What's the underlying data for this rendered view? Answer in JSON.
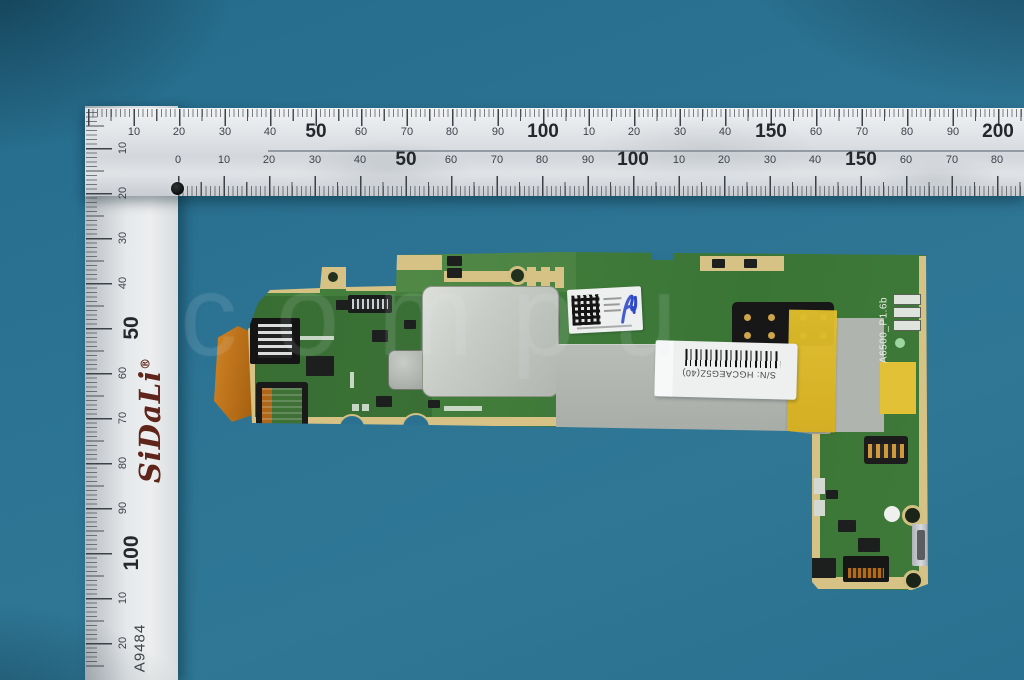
{
  "scene": {
    "description": "Tablet motherboard PCB photographed on a teal background with an L-square metal ruler",
    "background_color": "#2d7494",
    "watermark": "compu"
  },
  "ruler": {
    "brand": "SiDaLi",
    "registered_mark": "®",
    "model_code": "A9484",
    "unit": "mm",
    "horizontal_top_scale": [
      {
        "t": "10",
        "x": 134
      },
      {
        "t": "20",
        "x": 179
      },
      {
        "t": "30",
        "x": 225
      },
      {
        "t": "40",
        "x": 270
      },
      {
        "t": "50",
        "x": 316,
        "big": true
      },
      {
        "t": "60",
        "x": 361
      },
      {
        "t": "70",
        "x": 407
      },
      {
        "t": "80",
        "x": 452
      },
      {
        "t": "90",
        "x": 498
      },
      {
        "t": "100",
        "x": 543,
        "big": true
      },
      {
        "t": "10",
        "x": 589
      },
      {
        "t": "20",
        "x": 634
      },
      {
        "t": "30",
        "x": 680
      },
      {
        "t": "40",
        "x": 725
      },
      {
        "t": "150",
        "x": 771,
        "big": true
      },
      {
        "t": "60",
        "x": 816
      },
      {
        "t": "70",
        "x": 862
      },
      {
        "t": "80",
        "x": 907
      },
      {
        "t": "90",
        "x": 953
      },
      {
        "t": "200",
        "x": 998,
        "big": true
      }
    ],
    "horizontal_bottom_scale": [
      {
        "t": "0",
        "x": 178
      },
      {
        "t": "10",
        "x": 224
      },
      {
        "t": "20",
        "x": 269
      },
      {
        "t": "30",
        "x": 315
      },
      {
        "t": "40",
        "x": 360
      },
      {
        "t": "50",
        "x": 406,
        "big": true
      },
      {
        "t": "60",
        "x": 451
      },
      {
        "t": "70",
        "x": 497
      },
      {
        "t": "80",
        "x": 542
      },
      {
        "t": "90",
        "x": 588
      },
      {
        "t": "100",
        "x": 633,
        "big": true
      },
      {
        "t": "10",
        "x": 679
      },
      {
        "t": "20",
        "x": 724
      },
      {
        "t": "30",
        "x": 770
      },
      {
        "t": "40",
        "x": 815
      },
      {
        "t": "150",
        "x": 861,
        "big": true
      },
      {
        "t": "60",
        "x": 906
      },
      {
        "t": "70",
        "x": 952
      },
      {
        "t": "80",
        "x": 997
      }
    ],
    "vertical_scale": [
      {
        "t": "10",
        "y": 148
      },
      {
        "t": "20",
        "y": 193
      },
      {
        "t": "30",
        "y": 238
      },
      {
        "t": "40",
        "y": 283
      },
      {
        "t": "50",
        "y": 328,
        "big": true
      },
      {
        "t": "60",
        "y": 373
      },
      {
        "t": "70",
        "y": 418
      },
      {
        "t": "80",
        "y": 463
      },
      {
        "t": "90",
        "y": 508
      },
      {
        "t": "100",
        "y": 553,
        "big": true
      },
      {
        "t": "10",
        "y": 598
      },
      {
        "t": "20",
        "y": 643
      }
    ]
  },
  "pcb": {
    "silkscreen_code": "A6500_P1.6b",
    "serial_label": "S/N: HGCAEG5Z(40)",
    "colors": {
      "board_green": "#417c3b",
      "gold_pad": "#d6c285",
      "shield_gray": "#b7bbb5",
      "kapton_yellow": "#e0bd2e",
      "flex_orange": "#c97c20",
      "stamp_blue": "#2d49c9"
    }
  }
}
